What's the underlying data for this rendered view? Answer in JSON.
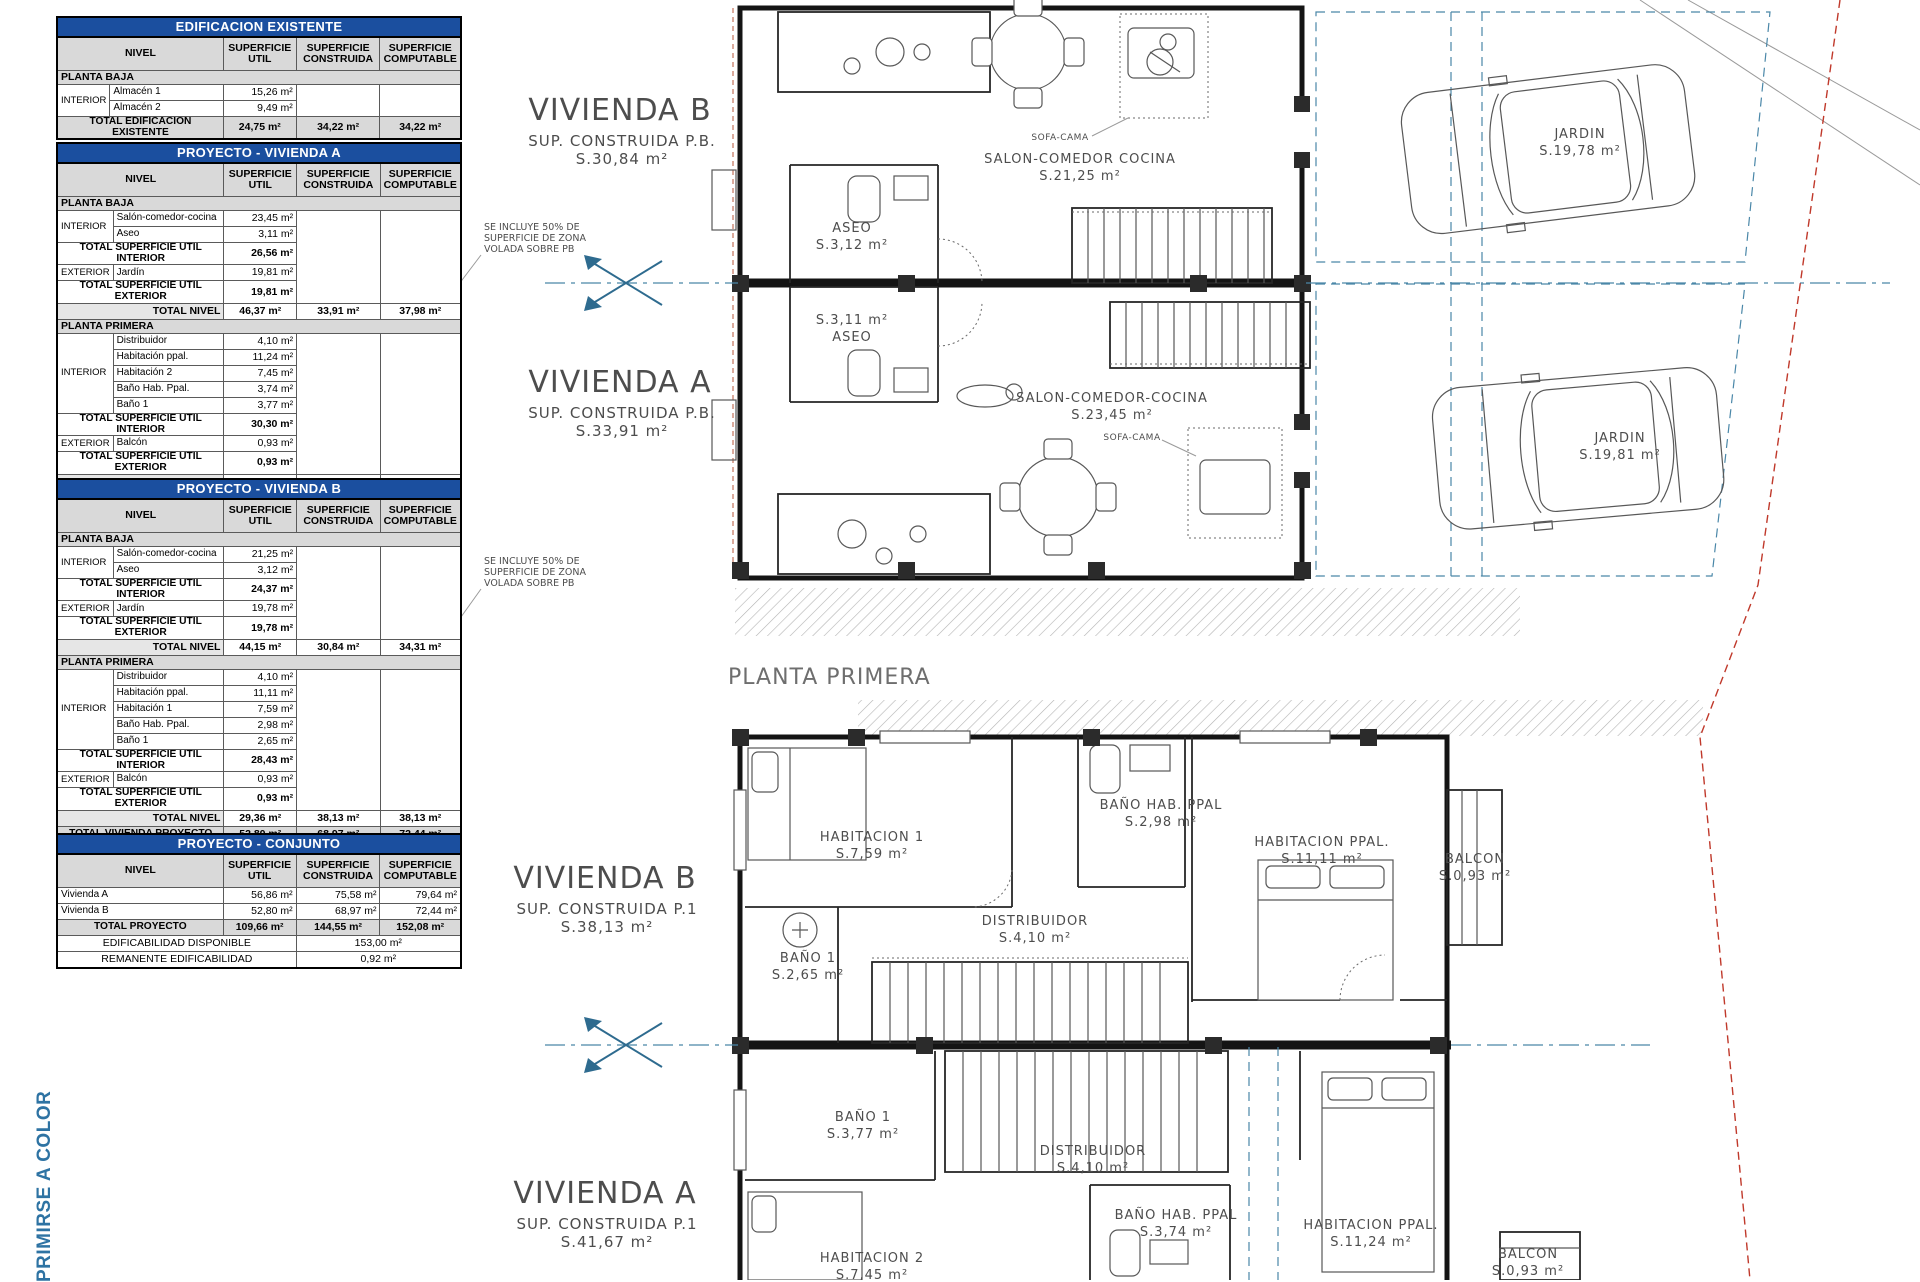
{
  "colors": {
    "title_bar": "#1b4f9f",
    "plan_accent": "#4a87a8",
    "boundary_red": "#c0392b",
    "side_note_blue": "#2e73a3"
  },
  "side_note": "PRIMIRSE A COLOR",
  "table_headers": {
    "nivel": "NIVEL",
    "util": "SUPERFICIE UTIL",
    "construida": "SUPERFICIE CONSTRUIDA",
    "computable": "SUPERFICIE COMPUTABLE"
  },
  "t1": {
    "title": "EDIFICACION EXISTENTE",
    "section": "PLANTA BAJA",
    "zone": "INTERIOR",
    "r1": {
      "name": "Almacén 1",
      "util": "15,26 m²"
    },
    "r2": {
      "name": "Almacén 2",
      "util": "9,49 m²"
    },
    "total": {
      "label": "TOTAL EDIFICACION EXISTENTE",
      "util": "24,75 m²",
      "cons": "34,22 m²",
      "comp": "34,22 m²"
    }
  },
  "t2": {
    "title": "PROYECTO - VIVIENDA A",
    "pb": {
      "section": "PLANTA BAJA",
      "zone_int": "INTERIOR",
      "zone_ext": "EXTERIOR",
      "i1": {
        "name": "Salón-comedor-cocina",
        "util": "23,45 m²"
      },
      "i2": {
        "name": "Aseo",
        "util": "3,11 m²"
      },
      "tot_int": {
        "label": "TOTAL SUPERFICIE UTIL INTERIOR",
        "util": "26,56 m²"
      },
      "e1": {
        "name": "Jardín",
        "util": "19,81 m²"
      },
      "tot_ext": {
        "label": "TOTAL SUPERFICIE UTIL EXTERIOR",
        "util": "19,81 m²"
      },
      "tot_nivel": {
        "label": "TOTAL NIVEL",
        "util": "46,37 m²",
        "cons": "33,91 m²",
        "comp": "37,98 m²"
      }
    },
    "p1": {
      "section": "PLANTA PRIMERA",
      "zone_int": "INTERIOR",
      "zone_ext": "EXTERIOR",
      "i1": {
        "name": "Distribuidor",
        "util": "4,10 m²"
      },
      "i2": {
        "name": "Habitación ppal.",
        "util": "11,24 m²"
      },
      "i3": {
        "name": "Habitación 2",
        "util": "7,45 m²"
      },
      "i4": {
        "name": "Baño Hab. Ppal.",
        "util": "3,74 m²"
      },
      "i5": {
        "name": "Baño 1",
        "util": "3,77 m²"
      },
      "tot_int": {
        "label": "TOTAL SUPERFICIE UTIL INTERIOR",
        "util": "30,30 m²"
      },
      "e1": {
        "name": "Balcón",
        "util": "0,93 m²"
      },
      "tot_ext": {
        "label": "TOTAL SUPERFICIE UTIL EXTERIOR",
        "util": "0,93 m²"
      },
      "tot_nivel": {
        "label": "TOTAL NIVEL",
        "util": "31,23 m²",
        "cons": "41,67 m²",
        "comp": "41,67 m²"
      }
    },
    "total": {
      "label": "TOTAL VIVIENDA PROYECTO",
      "util": "56,86 m²",
      "cons": "75,58 m²",
      "comp": "79,64 m²"
    }
  },
  "t3": {
    "title": "PROYECTO - VIVIENDA B",
    "pb": {
      "section": "PLANTA BAJA",
      "zone_int": "INTERIOR",
      "zone_ext": "EXTERIOR",
      "i1": {
        "name": "Salón-comedor-cocina",
        "util": "21,25 m²"
      },
      "i2": {
        "name": "Aseo",
        "util": "3,12 m²"
      },
      "tot_int": {
        "label": "TOTAL SUPERFICIE UTIL INTERIOR",
        "util": "24,37 m²"
      },
      "e1": {
        "name": "Jardín",
        "util": "19,78 m²"
      },
      "tot_ext": {
        "label": "TOTAL SUPERFICIE UTIL EXTERIOR",
        "util": "19,78 m²"
      },
      "tot_nivel": {
        "label": "TOTAL NIVEL",
        "util": "44,15 m²",
        "cons": "30,84 m²",
        "comp": "34,31 m²"
      }
    },
    "p1": {
      "section": "PLANTA PRIMERA",
      "zone_int": "INTERIOR",
      "zone_ext": "EXTERIOR",
      "i1": {
        "name": "Distribuidor",
        "util": "4,10 m²"
      },
      "i2": {
        "name": "Habitación ppal.",
        "util": "11,11 m²"
      },
      "i3": {
        "name": "Habitación 1",
        "util": "7,59 m²"
      },
      "i4": {
        "name": "Baño Hab. Ppal.",
        "util": "2,98 m²"
      },
      "i5": {
        "name": "Baño 1",
        "util": "2,65 m²"
      },
      "tot_int": {
        "label": "TOTAL SUPERFICIE UTIL INTERIOR",
        "util": "28,43 m²"
      },
      "e1": {
        "name": "Balcón",
        "util": "0,93 m²"
      },
      "tot_ext": {
        "label": "TOTAL SUPERFICIE UTIL EXTERIOR",
        "util": "0,93 m²"
      },
      "tot_nivel": {
        "label": "TOTAL NIVEL",
        "util": "29,36 m²",
        "cons": "38,13 m²",
        "comp": "38,13 m²"
      }
    },
    "total": {
      "label": "TOTAL VIVIENDA PROYECTO",
      "util": "52,80 m²",
      "cons": "68,97 m²",
      "comp": "72,44 m²"
    }
  },
  "t4": {
    "title": "PROYECTO - CONJUNTO",
    "r1": {
      "name": "Vivienda A",
      "util": "56,86 m²",
      "cons": "75,58 m²",
      "comp": "79,64 m²"
    },
    "r2": {
      "name": "Vivienda B",
      "util": "52,80 m²",
      "cons": "68,97 m²",
      "comp": "72,44 m²"
    },
    "total": {
      "label": "TOTAL PROYECTO",
      "util": "109,66 m²",
      "cons": "144,55 m²",
      "comp": "152,08 m²"
    },
    "edif": {
      "label": "EDIFICABILIDAD DISPONIBLE",
      "value": "153,00 m²"
    },
    "rem": {
      "label": "REMANENTE EDIFICABILIDAD",
      "value": "0,92 m²"
    }
  },
  "plan": {
    "floor_title": "PLANTA PRIMERA",
    "note1_l1": "SE INCLUYE 50% DE",
    "note1_l2": "SUPERFICIE DE ZONA",
    "note1_l3": "VOLADA SOBRE PB",
    "note2_l1": "SE INCLUYE 50% DE",
    "note2_l2": "SUPERFICIE DE ZONA",
    "note2_l3": "VOLADA SOBRE PB",
    "pb": {
      "viv_b": {
        "title": "VIVIENDA B",
        "sub": "SUP. CONSTRUIDA P.B.",
        "area": "S.30,84 m²"
      },
      "viv_a": {
        "title": "VIVIENDA A",
        "sub": "SUP. CONSTRUIDA P.B.",
        "area": "S.33,91 m²"
      },
      "rooms": {
        "aseo_b": {
          "l1": "ASEO",
          "l2": "S.3,12 m²"
        },
        "aseo_a": {
          "l1": "S.3,11 m²",
          "l2": "ASEO"
        },
        "salon_b": {
          "l1": "SALON-COMEDOR COCINA",
          "l2": "S.21,25 m²"
        },
        "salon_a": {
          "l1": "SALON-COMEDOR-COCINA",
          "l2": "S.23,45 m²"
        },
        "sofa_b": "SOFA-CAMA",
        "sofa_a": "SOFA-CAMA",
        "jardin_b": {
          "l1": "JARDIN",
          "l2": "S.19,78 m²"
        },
        "jardin_a": {
          "l1": "JARDIN",
          "l2": "S.19,81 m²"
        }
      }
    },
    "p1": {
      "viv_b": {
        "title": "VIVIENDA B",
        "sub": "SUP. CONSTRUIDA P.1",
        "area": "S.38,13 m²"
      },
      "viv_a": {
        "title": "VIVIENDA A",
        "sub": "SUP. CONSTRUIDA P.1",
        "area": "S.41,67 m²"
      },
      "rooms": {
        "hab1": {
          "l1": "HABITACION 1",
          "l2": "S.7,59 m²"
        },
        "bano_ppal_b": {
          "l1": "BAÑO HAB. PPAL",
          "l2": "S.2,98 m²"
        },
        "hab_ppal_b": {
          "l1": "HABITACION PPAL.",
          "l2": "S.11,11 m²"
        },
        "balcon_b": {
          "l1": "BALCON",
          "l2": "S.0,93 m²"
        },
        "distr_b": {
          "l1": "DISTRIBUIDOR",
          "l2": "S.4,10 m²"
        },
        "bano1_b": {
          "l1": "BAÑO 1",
          "l2": "S.2,65 m²"
        },
        "bano1_a": {
          "l1": "BAÑO 1",
          "l2": "S.3,77 m²"
        },
        "distr_a": {
          "l1": "DISTRIBUIDOR",
          "l2": "S.4,10 m²"
        },
        "bano_ppal_a": {
          "l1": "BAÑO HAB. PPAL",
          "l2": "S.3,74 m²"
        },
        "hab_ppal_a": {
          "l1": "HABITACION PPAL.",
          "l2": "S.11,24 m²"
        },
        "balcon_a": {
          "l1": "BALCON",
          "l2": "S.0,93 m²"
        },
        "hab2": {
          "l1": "HABITACION 2",
          "l2": "S.7,45 m²"
        }
      }
    }
  }
}
